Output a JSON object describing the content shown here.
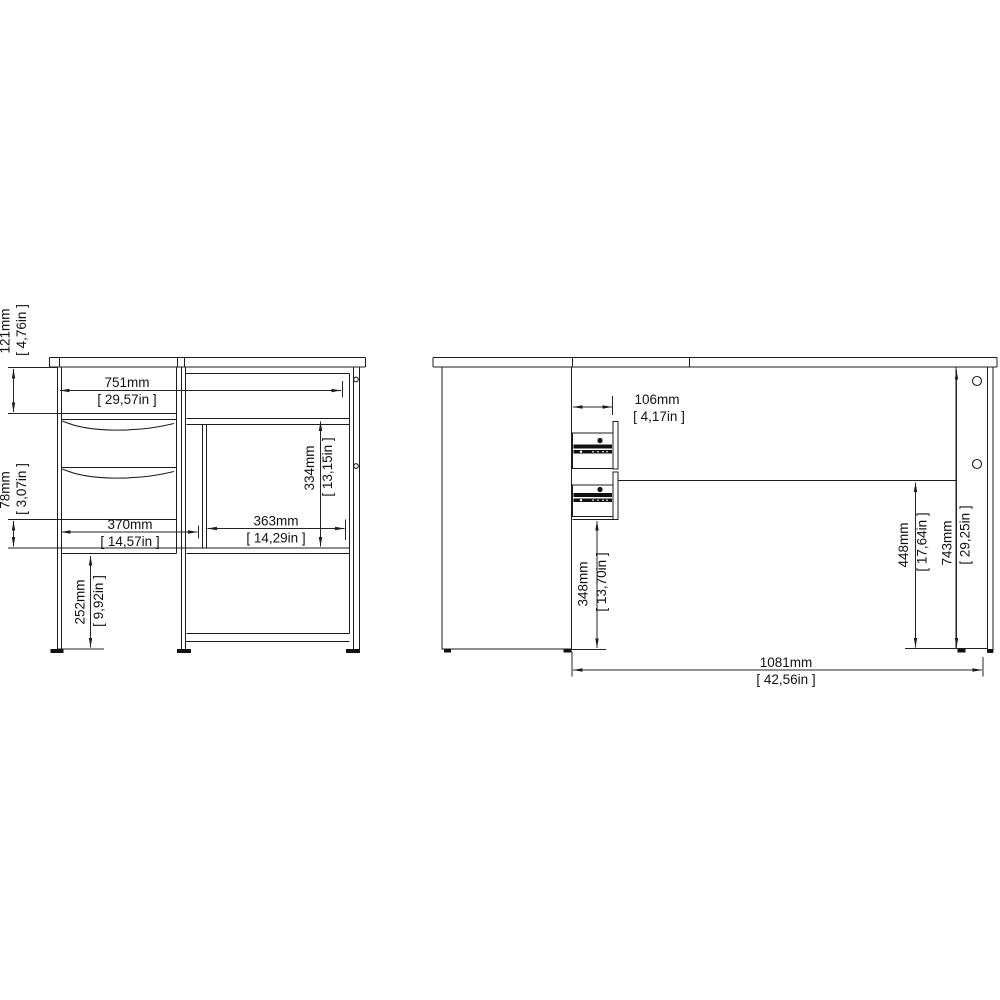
{
  "page": {
    "background": "#ffffff",
    "line_color": "#1c1c1c",
    "text_color": "#111111"
  },
  "views": {
    "front": {
      "dims": {
        "d121": {
          "mm": "121mm",
          "inches": "[ 4,76in ]"
        },
        "d78": {
          "mm": "78mm",
          "inches": "[ 3,07in ]"
        },
        "d252": {
          "mm": "252mm",
          "inches": "[ 9,92in ]"
        },
        "d751": {
          "mm": "751mm",
          "inches": "[ 29,57in ]"
        },
        "d370": {
          "mm": "370mm",
          "inches": "[ 14,57in ]"
        },
        "d363": {
          "mm": "363mm",
          "inches": "[ 14,29in ]"
        },
        "d334": {
          "mm": "334mm",
          "inches": "[ 13,15in ]"
        }
      }
    },
    "side": {
      "dims": {
        "d106": {
          "mm": "106mm",
          "inches": "[ 4,17in ]"
        },
        "d348": {
          "mm": "348mm",
          "inches": "[ 13,70in ]"
        },
        "d448": {
          "mm": "448mm",
          "inches": "[ 17,64in ]"
        },
        "d743": {
          "mm": "743mm",
          "inches": "[ 29,25in ]"
        },
        "d1081": {
          "mm": "1081mm",
          "inches": "[ 42,56in ]"
        }
      }
    }
  }
}
